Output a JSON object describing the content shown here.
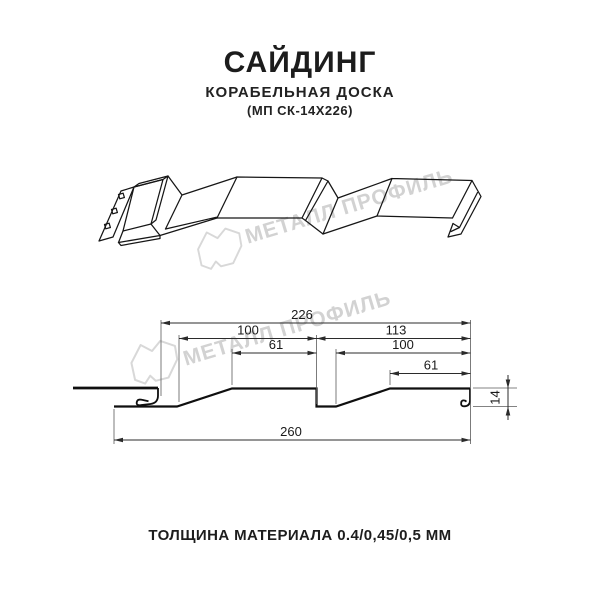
{
  "product": {
    "title": "САЙДИНГ",
    "subtitle": "КОРАБЕЛЬНАЯ ДОСКА",
    "model_code": "(МП СК-14Х226)",
    "thickness_note": "ТОЛЩИНА МАТЕРИАЛА 0.4/0,45/0,5 ММ"
  },
  "watermark": {
    "text": "МЕТАЛЛ ПРОФИЛЬ",
    "logo_icon": "metall-profil-logo",
    "color": "#d2d2d2"
  },
  "drawing": {
    "units": "mm",
    "dimensions": {
      "overall_cover_width": "226",
      "panel1_width": "100",
      "panel2_width": "113",
      "panel1_flat": "61",
      "panel2_inner": "100",
      "panel2_flat": "61",
      "total_width": "260",
      "profile_height": "14"
    }
  },
  "colors": {
    "line": "#141414",
    "dimension_line": "#2b2b2b",
    "watermark": "#d2d2d2",
    "background": "#ffffff"
  }
}
